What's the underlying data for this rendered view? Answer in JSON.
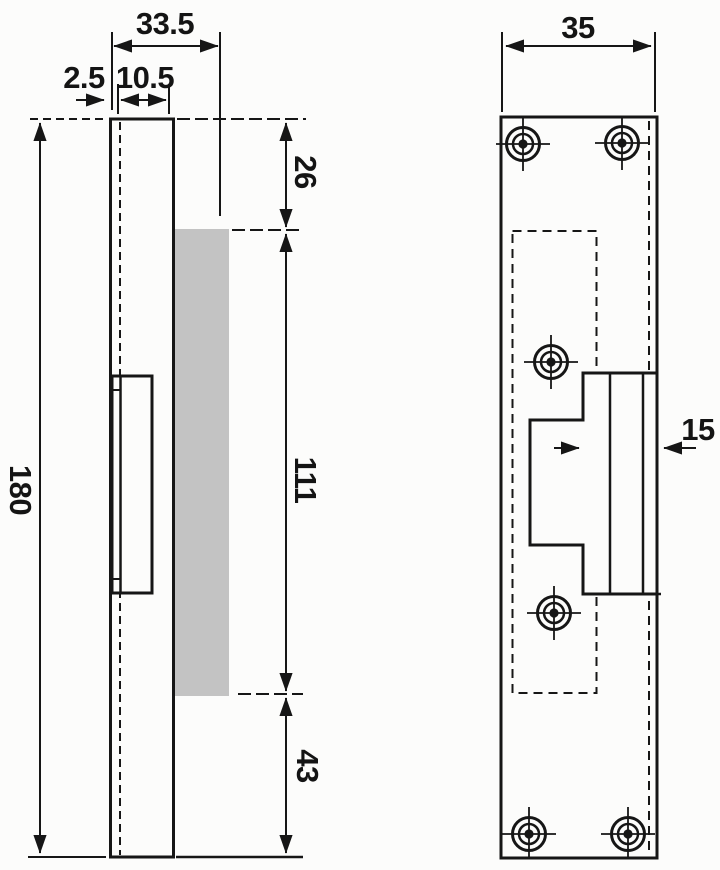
{
  "drawing": {
    "side_view": {
      "overall_depth": "33.5",
      "faceplate_thickness": "2.5",
      "body_depth": "10.5",
      "overall_height": "180",
      "top_to_cutout": "26",
      "cutout_height": "111",
      "cutout_to_bottom": "43"
    },
    "front_view": {
      "overall_width": "35",
      "latch_width": "15"
    },
    "colors": {
      "line": "#161616",
      "background": "#fcfcfb",
      "highlight": "#c3c3c3"
    }
  }
}
